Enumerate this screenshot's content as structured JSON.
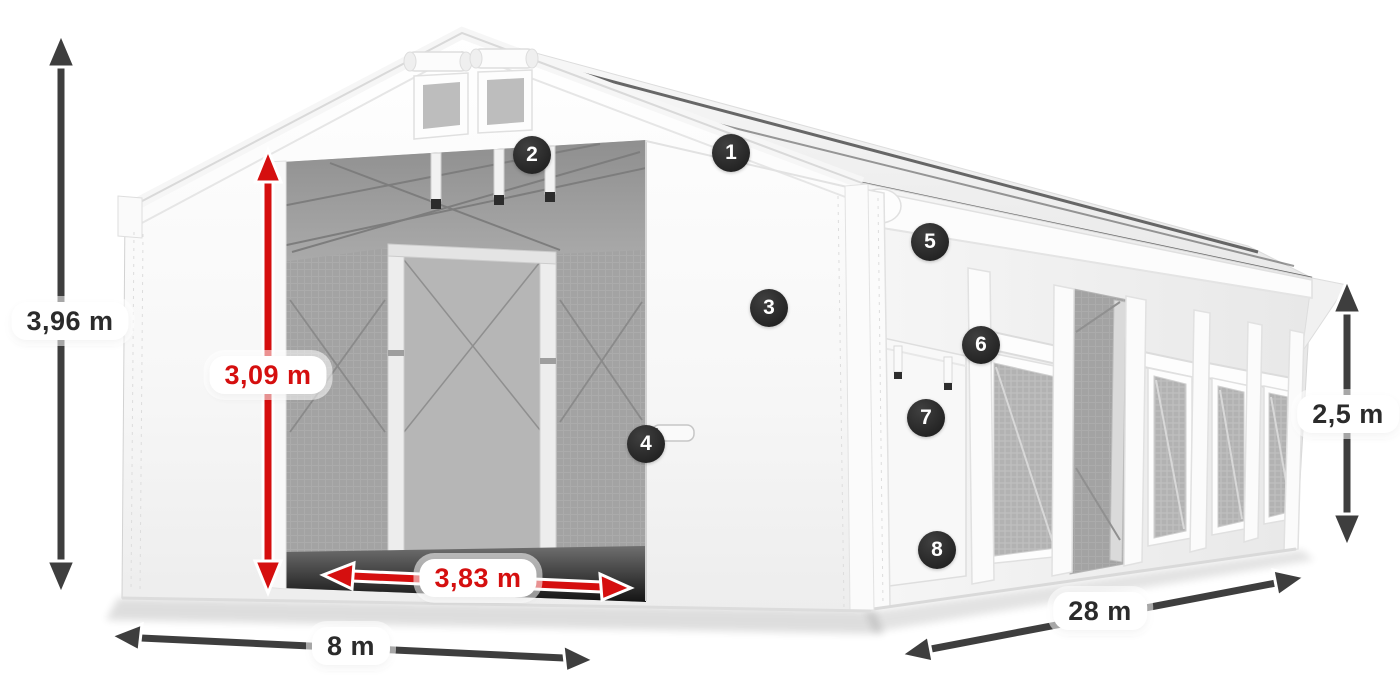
{
  "diagram": {
    "type": "product-dimension-diagram",
    "subject": "White PVC storage tent, front-left view with open gable entrance, side wall with mesh windows",
    "background_color": "#ffffff"
  },
  "colors": {
    "dimension_red": "#d50f0f",
    "dimension_dark": "#3e3e3e",
    "marker_background": "#2b2b2b",
    "label_background": "#ffffff",
    "label_text": "#2b2b2b"
  },
  "dimensions": {
    "total_height": {
      "label": "3,96 m",
      "style": "dark"
    },
    "entrance_height": {
      "label": "3,09 m",
      "style": "red"
    },
    "entrance_width": {
      "label": "3,83 m",
      "style": "red"
    },
    "width": {
      "label": "8 m",
      "style": "dark"
    },
    "length": {
      "label": "28 m",
      "style": "dark"
    },
    "side_height": {
      "label": "2,5 m",
      "style": "dark"
    }
  },
  "markers": {
    "m1": "1",
    "m2": "2",
    "m3": "3",
    "m4": "4",
    "m5": "5",
    "m6": "6",
    "m7": "7",
    "m8": "8"
  }
}
